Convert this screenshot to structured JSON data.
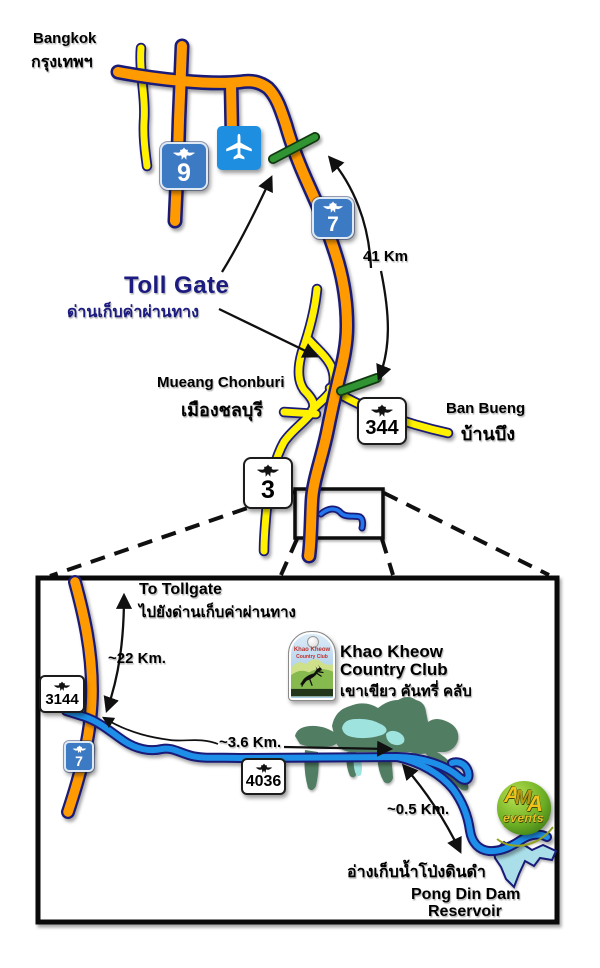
{
  "colors": {
    "road_orange": "#FF9A00",
    "road_outline": "#1A1A78",
    "road_yellow": "#FFF100",
    "road_blue": "#1E8FE8",
    "toll_green": "#2F9431",
    "golf_green": "#517D63",
    "lake_cyan": "#9FE3DF",
    "reservoir_cyan": "#AADFE9",
    "shield_blue": "#3C7AC4",
    "airport_blue": "#1E8FE0",
    "navy_text": "#1B1B80"
  },
  "main_map": {
    "bangkok_en": "Bangkok",
    "bangkok_th": "กรุงเทพฯ",
    "tollgate_en": "Toll Gate",
    "tollgate_th": "ด่านเก็บค่าผ่านทาง",
    "distance_41": "41 Km",
    "chonburi_en": "Mueang Chonburi",
    "chonburi_th": "เมืองชลบุรี",
    "banbueng_en": "Ban Bueng",
    "banbueng_th": "บ้านบึง",
    "shield_9": "9",
    "shield_7": "7",
    "shield_344": "344",
    "shield_3": "3"
  },
  "inset_map": {
    "to_tollgate_en": "To Tollgate",
    "to_tollgate_th": "ไปยังด่านเก็บค่าผ่านทาง",
    "distance_22": "~22 Km.",
    "distance_36": "~3.6 Km.",
    "distance_05": "~0.5 Km.",
    "shield_3144": "3144",
    "shield_7": "7",
    "shield_4036": "4036",
    "club_en_1": "Khao Kheow",
    "club_en_2": "Country Club",
    "club_th": "เขาเขียว คันทรี่ คลับ",
    "reservoir_th": "อ่างเก็บน้ำโป่งดินดำ",
    "reservoir_en_1": "Pong Din Dam",
    "reservoir_en_2": "Reservoir",
    "club_logo": {
      "line1": "Khao Kheow",
      "line2": "Country Club"
    },
    "ama_logo": {
      "a1": "A",
      "m": "M",
      "a2": "A",
      "events": "events"
    }
  }
}
